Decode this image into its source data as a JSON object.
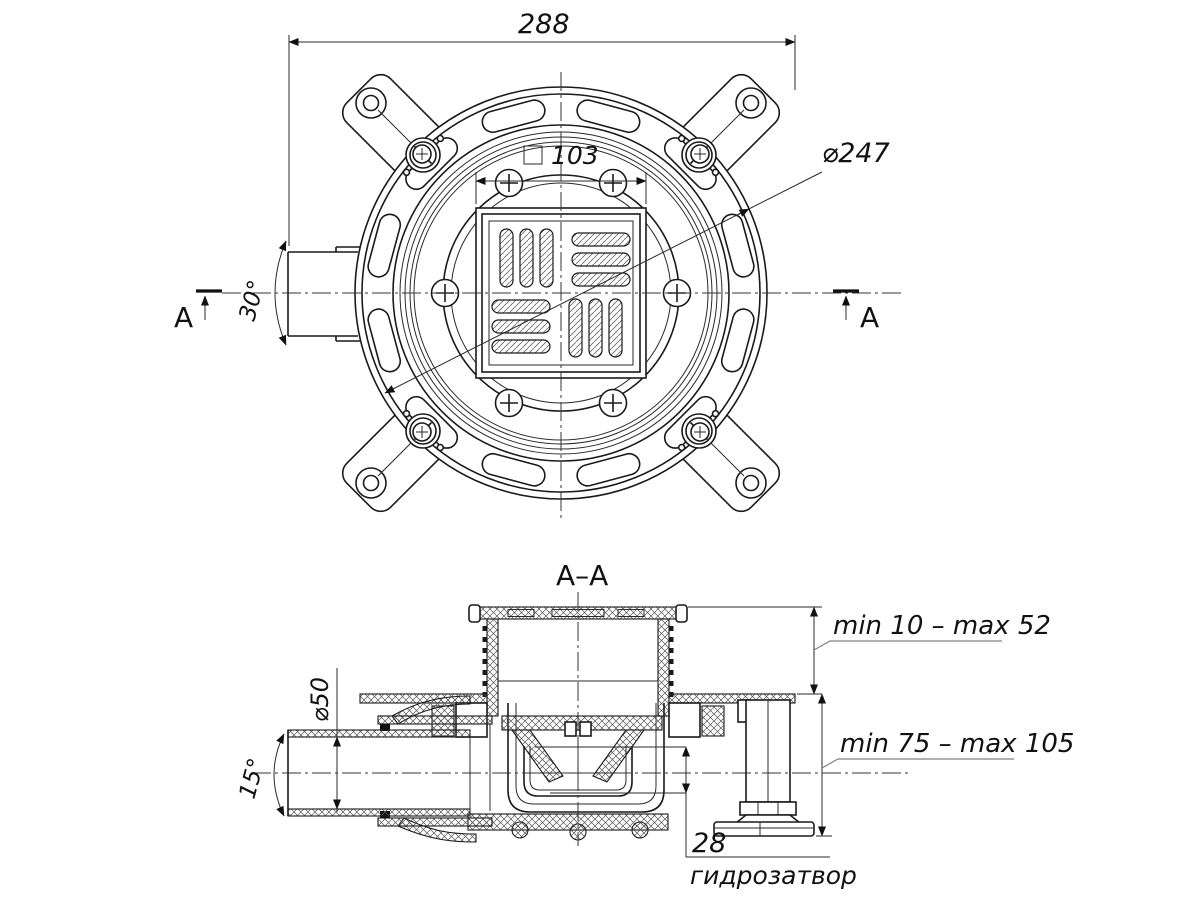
{
  "drawing": {
    "section_title": "A–A",
    "section_marker_left": "A",
    "section_marker_right": "A",
    "top_view": {
      "dim_overall_width": "288",
      "dim_grate_square_prefix": "□",
      "dim_grate_square_size": "103",
      "dim_flange_diameter": "⌀247",
      "dim_outlet_swivel_angle": "30°"
    },
    "section_view": {
      "dim_grate_adjust_range": "min 10 – max 52",
      "dim_body_height_range": "min 75 – max 105",
      "dim_outlet_pipe_diameter": "⌀50",
      "dim_outlet_tilt_angle": "15°",
      "dim_water_seal_height": "28",
      "label_water_seal": "гидрозатвор"
    },
    "line_color": "#1a1a1a"
  }
}
